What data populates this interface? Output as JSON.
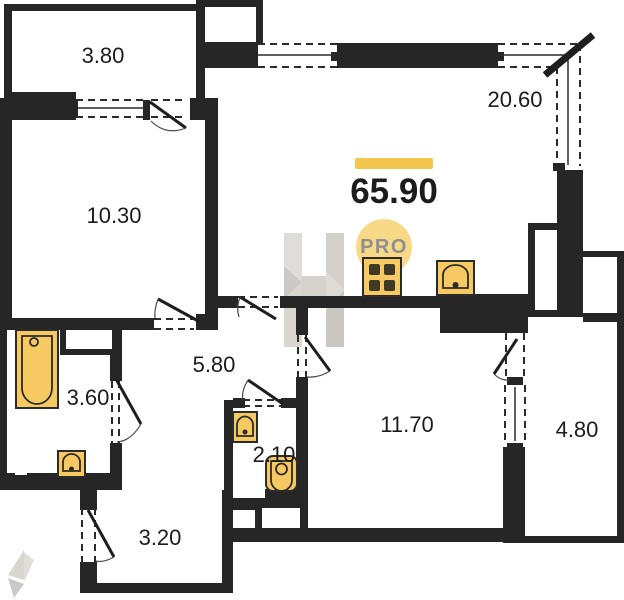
{
  "plan": {
    "total": {
      "area": "65.90"
    },
    "rooms": [
      {
        "name": "loggia-top",
        "area": "3.80"
      },
      {
        "name": "bedroom",
        "area": "10.30"
      },
      {
        "name": "kitchen-living-room",
        "area": "20.60"
      },
      {
        "name": "hallway",
        "area": "5.80"
      },
      {
        "name": "bathroom",
        "area": "3.60"
      },
      {
        "name": "wc",
        "area": "2.10"
      },
      {
        "name": "bedroom-2",
        "area": "11.70"
      },
      {
        "name": "loggia-right",
        "area": "4.80"
      },
      {
        "name": "entry-hall",
        "area": "3.20"
      }
    ],
    "watermark": {
      "label": "PRO"
    },
    "icons": {
      "bathtub": "bathtub-icon",
      "toilet": "toilet-icon",
      "stove": "stove-icon",
      "kitchen_sink": "sink-icon",
      "bathroom_sink": "sink-icon",
      "wc_sink": "sink-icon"
    },
    "colors": {
      "wall": "#262626",
      "line": "#2b2b2b",
      "fixture_fill": "#f6c963",
      "fixture_stroke": "#2b2b2b",
      "burner": "#3f3a26",
      "accent_bar": "#f3c64e",
      "watermark_circle": "#f6cf69",
      "watermark_gray": "#d5d1cb",
      "label_text": "#1c1c1e",
      "pro_text": "#8f8f8f"
    }
  }
}
